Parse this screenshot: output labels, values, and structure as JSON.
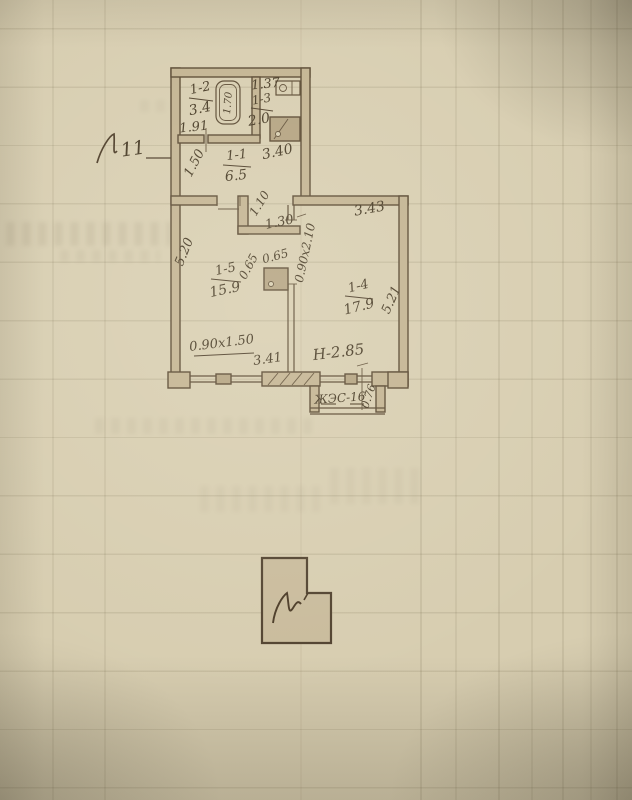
{
  "plan": {
    "apartment_mark": "11",
    "rooms": {
      "r12": {
        "number": "1-2",
        "area": "3.4"
      },
      "r13": {
        "number": "1-3",
        "area": "2.0"
      },
      "r11": {
        "number": "1-1",
        "area": "6.5"
      },
      "r15": {
        "number": "1-5",
        "area": "15.9"
      },
      "r14": {
        "number": "1-4",
        "area": "17.9"
      }
    },
    "dims": {
      "wc_width": "1.37",
      "bath_width": "1.91",
      "hall_width": "1.50",
      "hall_length": "3.40",
      "niche_depth": "1.10",
      "niche_width": "1.30",
      "shaft_a": "0.65",
      "shaft_b": "0.65",
      "door_living": "0.90x2.10",
      "room14_width": "3.43",
      "room14_depth": "5.21",
      "room15_depth": "5.20",
      "room15_width": "3.41",
      "window15": "0.90x1.50",
      "ceiling_height": "Н-2.85",
      "balcony_width": "0.76",
      "tub_length": "1.70",
      "balcony_label": "ЖЭС-16"
    }
  }
}
